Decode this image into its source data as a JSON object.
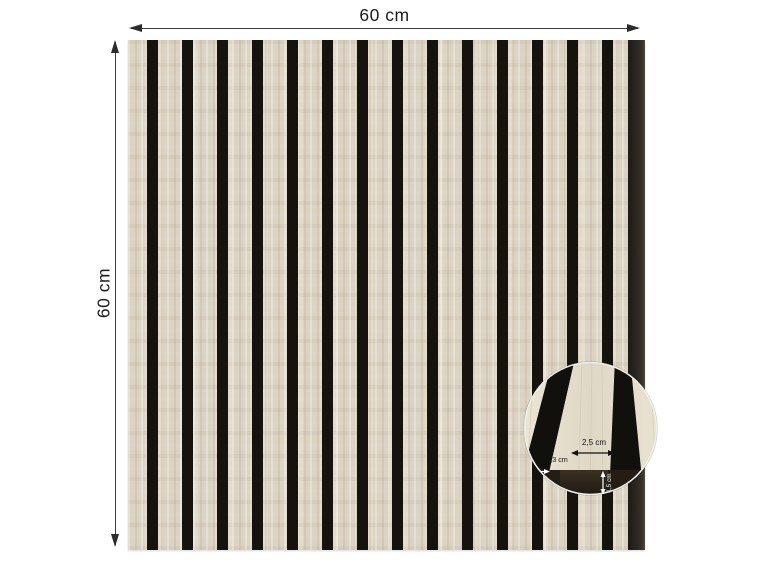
{
  "diagram": {
    "type": "product-dimension-diagram",
    "product": "wood slat acoustic wall panel, vertical lamellas on black felt",
    "panel": {
      "width_label": "60 cm",
      "height_label": "60 cm"
    },
    "inset": {
      "slat_width_label": "2,5 cm",
      "gap_width_label": "1,3 cm",
      "depth_label": "1,5 cm"
    },
    "colors": {
      "background": "#ffffff",
      "slat_wood": "#e4dccb",
      "felt_gap": "#16120d",
      "right_edge_band": "#2b2722",
      "dimension_line": "#3d3d3d",
      "inset_bottom_band": "#241d15",
      "inset_label_dark": "#111111",
      "inset_label_light": "#ffffff"
    }
  }
}
